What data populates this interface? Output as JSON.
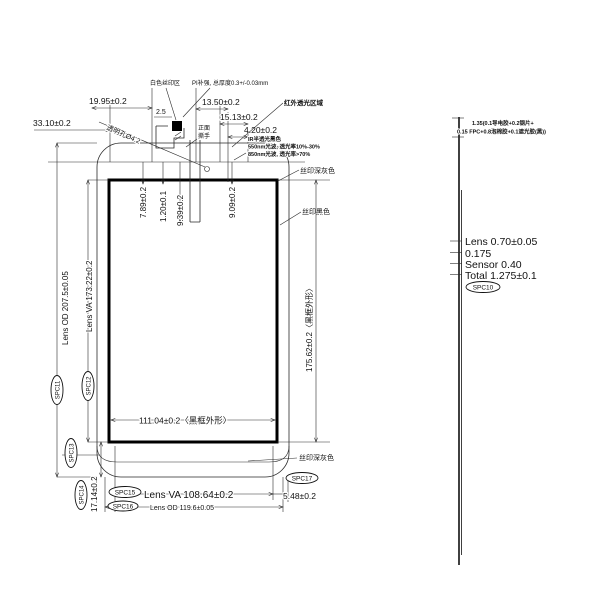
{
  "labels": {
    "white_silk": "白色丝印区",
    "pi": "PI补强, 总厚度0.3+/-0.03mm",
    "region_bold": "红外透光区域",
    "ir1": "IR半透光黑色",
    "ir2": "550nm光波, 透光率10%-30%",
    "ir3": "850nm光波, 透光率>70%",
    "tab1": "正面",
    "tab2": "撕手",
    "hole": "透明孔Ø4.2",
    "silk_gray_top": "丝印深灰色",
    "silk_black": "丝印黑色",
    "silk_gray_bottom": "丝印深灰色"
  },
  "dims": {
    "d1995": "19.95±0.2",
    "d3310": "33.10±0.2",
    "d1350": "13.50±0.2",
    "d1513": "15.13±0.2",
    "d420": "4.20±0.2",
    "d25": "2.5",
    "d789": "7.89±0.2",
    "d120": "1.20±0.1",
    "d939": "9.39±0.2",
    "d909": "9.09±0.2",
    "lens_od_v": "Lens OD 207.5±0.05",
    "lens_va_v": "Lens VA 173.22±0.2",
    "d17562": "175.62±0.2〈黑框外形〉",
    "d11104": "111.04±0.2〈黑框外形〉",
    "d1714": "17.14±0.2",
    "lens_va_h": "Lens VA 108.64±0.2",
    "lens_od_h": "Lens OD 119.6±0.05",
    "d548": "5.48±0.2"
  },
  "tags": {
    "spc10": "SPC10",
    "spc11": "SPC11",
    "spc12": "SPC12",
    "spc13": "SPC13",
    "spc14": "SPC14",
    "spc15": "SPC15",
    "spc16": "SPC16",
    "spc17": "SPC17"
  },
  "stack": {
    "note1": "1.35(0.1导电胶+0.2钢片+",
    "note2": "0.15 FPC+0.8泡棉胶+0.1遮光胶(黑))",
    "lens": "Lens 0.70±0.05",
    "oca": "0.175",
    "sensor": "Sensor 0.40",
    "total": "Total 1.275±0.1"
  },
  "colors": {
    "line": "#2a2a2a",
    "text": "#111111",
    "background": "#ffffff"
  }
}
